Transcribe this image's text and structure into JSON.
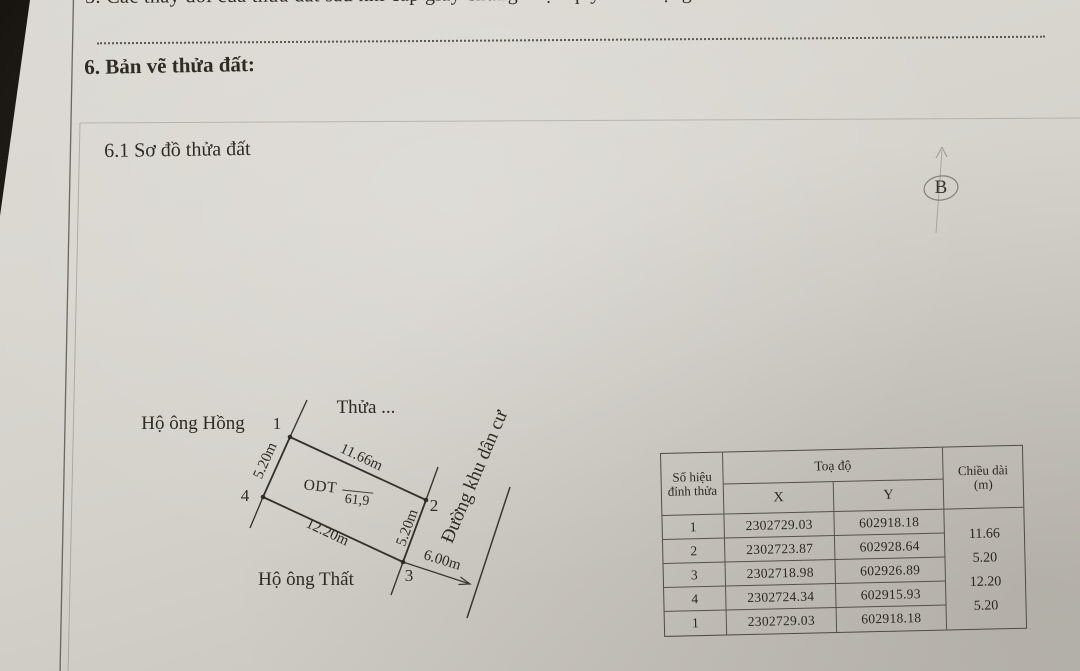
{
  "header": {
    "section5_text": "5. Các thay đổi của thửa đất sau khi cấp giấy chứng nhận quyền sử dụng đất ....",
    "section6_title": "6. Bản vẽ thửa đất:",
    "subsection_title": "6.1 Sơ đồ thửa đất",
    "annotation_letter": "B"
  },
  "diagram": {
    "parcel_name": "Thửa ...",
    "neighbor_top": "Hộ ông Hồng",
    "neighbor_bottom": "Hộ ông Thất",
    "road_name": "Đường khu dân cư",
    "land_use_code": "ODT",
    "area_m2": "61,9",
    "vertex_1": "1",
    "vertex_2": "2",
    "vertex_3": "3",
    "vertex_4": "4",
    "edge_top": "11.66m",
    "edge_left": "5.20m",
    "edge_bottom": "12.20m",
    "edge_right": "5.20m",
    "road_width": "6.00m"
  },
  "table": {
    "header_vertex_line1": "Số hiệu",
    "header_vertex_line2": "đỉnh thửa",
    "header_coords": "Toạ độ",
    "header_x": "X",
    "header_y": "Y",
    "header_length_line1": "Chiều dài",
    "header_length_line2": "(m)",
    "rows": [
      {
        "id": "1",
        "x": "2302729.03",
        "y": "602918.18"
      },
      {
        "id": "2",
        "x": "2302723.87",
        "y": "602928.64"
      },
      {
        "id": "3",
        "x": "2302718.98",
        "y": "602926.89"
      },
      {
        "id": "4",
        "x": "2302724.34",
        "y": "602915.93"
      },
      {
        "id": "1",
        "x": "2302729.03",
        "y": "602918.18"
      }
    ],
    "lengths": [
      "11.66",
      "5.20",
      "12.20",
      "5.20"
    ]
  }
}
